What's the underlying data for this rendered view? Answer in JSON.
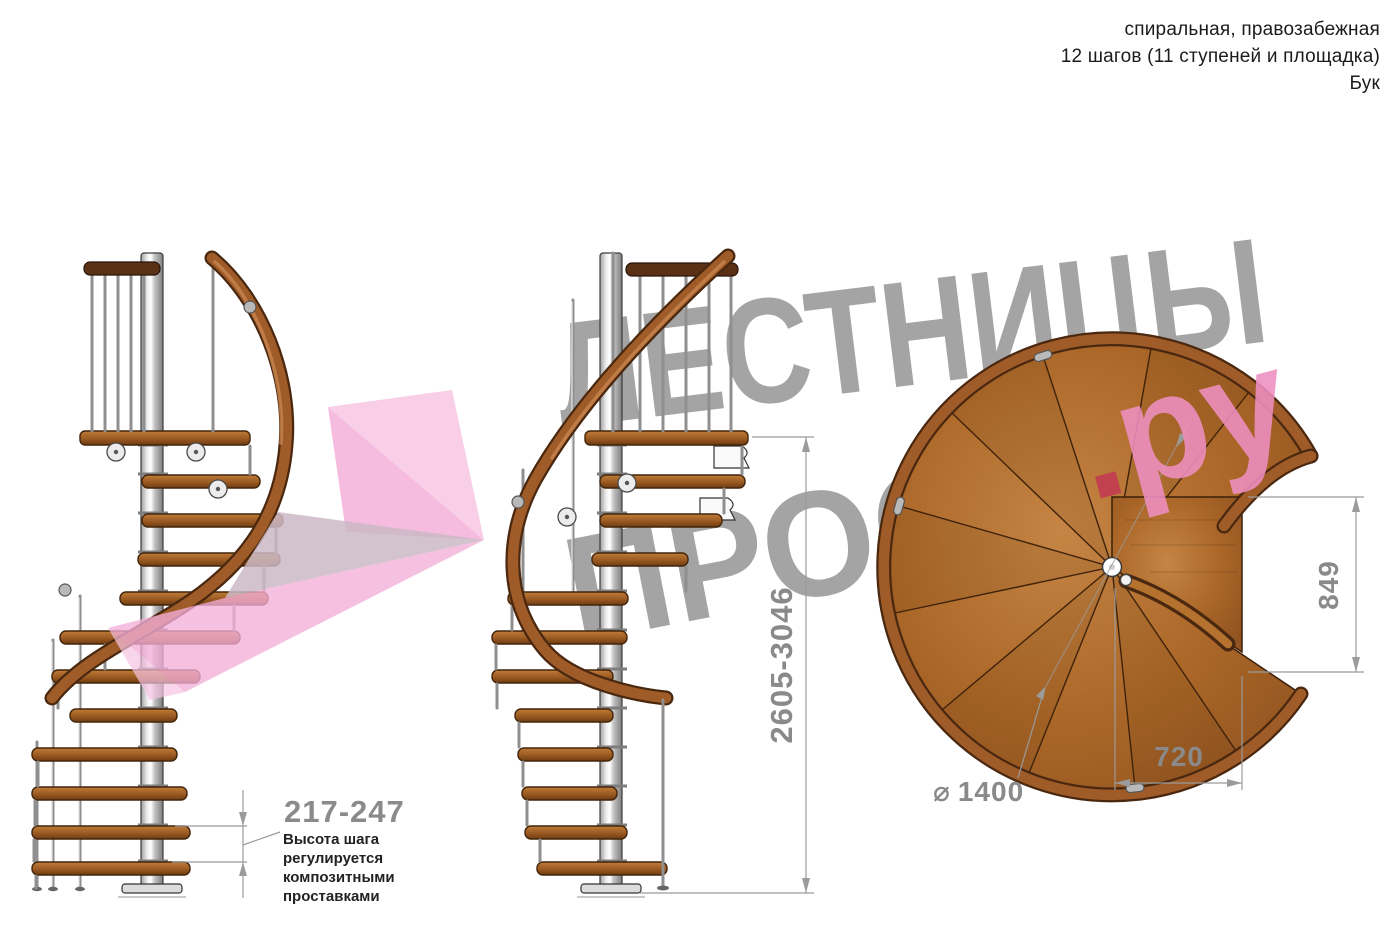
{
  "header": {
    "line1": "спиральная, правозабежная",
    "line2": "12 шагов (11 ступеней и площадка)",
    "line3": "Бук"
  },
  "watermark": {
    "line1": "ЛЕСТНИЦЫ",
    "line2": "ПРОСТО",
    "dot": ".",
    "suffix": "ру",
    "gray": "#9d9d9d",
    "pink": "#ef8fc1",
    "crimson": "#c23a52",
    "arrow_pink_light": "#f7c3e2",
    "arrow_pink_mid": "#f3abd7",
    "arrow_gray": "#cbb9c5"
  },
  "dimensions": {
    "step_height": {
      "value": "217-247",
      "note": "Высота шага регулируется композитными проставками"
    },
    "total_height": {
      "value": "2605-3046"
    },
    "platform_depth": {
      "value": "849"
    },
    "platform_width": {
      "value": "720"
    },
    "diameter": {
      "symbol": "⌀",
      "value": "1400"
    }
  },
  "colors": {
    "wood": "#a9652a",
    "wood_dark": "#4a2810",
    "pole": "#c9c9c9",
    "dimension_gray": "#8a8a8a",
    "text": "#1b1b1b"
  }
}
